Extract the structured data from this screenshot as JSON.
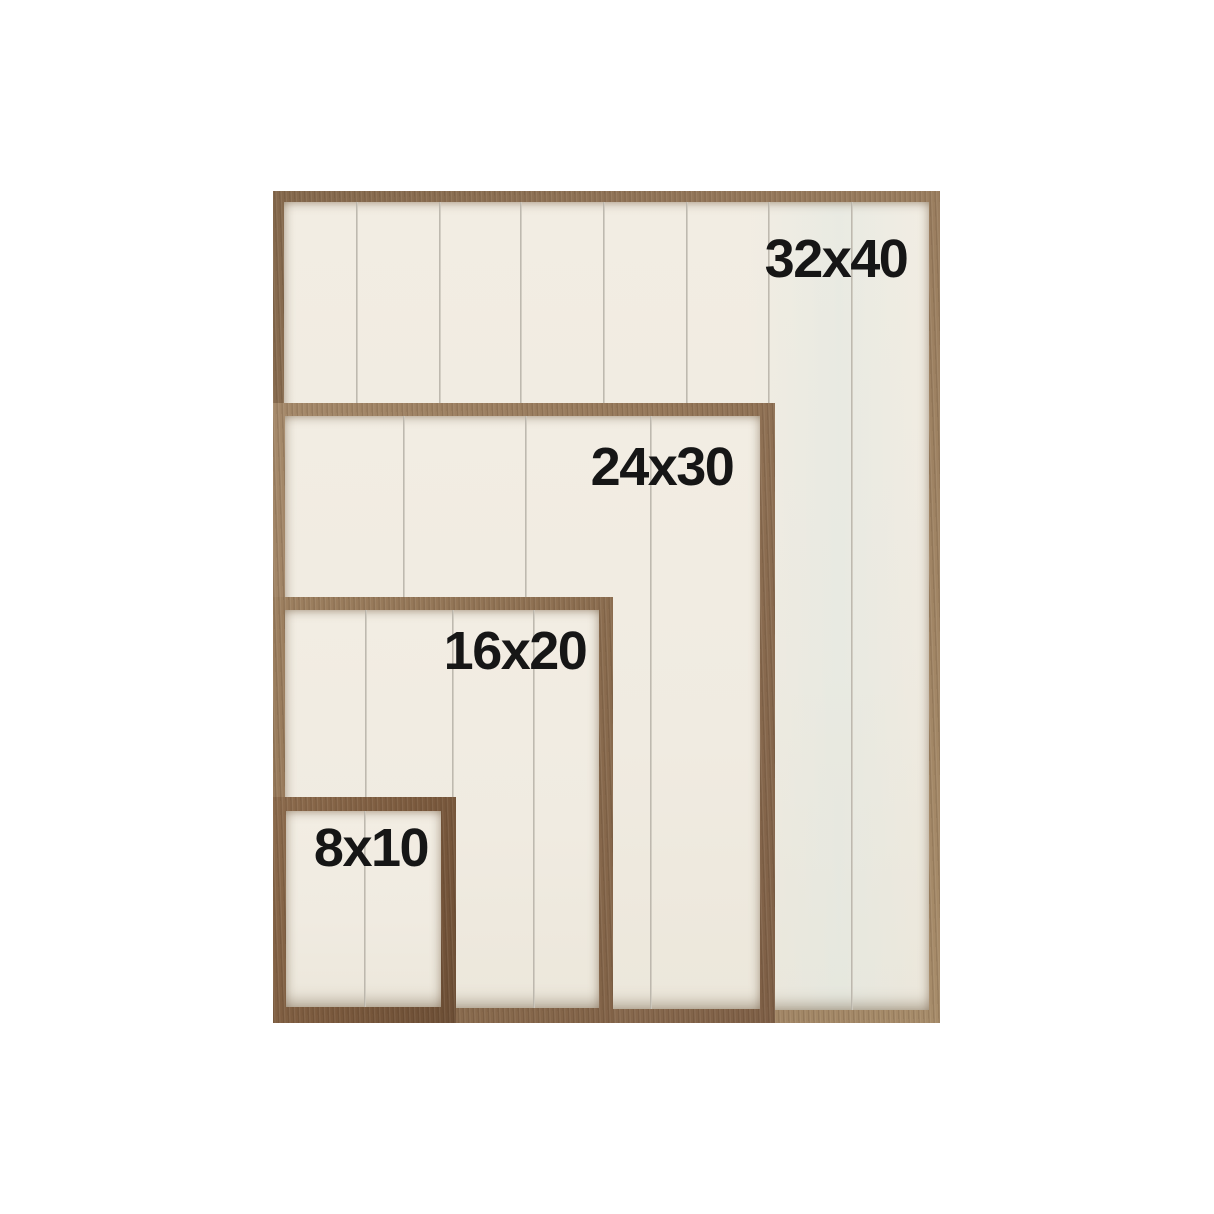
{
  "page": {
    "description": "Size comparison chart of rustic wood-framed shiplap signs nested by their shared bottom-left corner",
    "background_color": "#ffffff"
  },
  "colors": {
    "panel_cream": "#f0ebe1",
    "plank_line_gray": "#b5b0a6",
    "wood_light_tan": "#a78c6a",
    "wood_medium_brown": "#8d6f51",
    "wood_dark_walnut": "#6c4e35",
    "label_text": "#161616"
  },
  "frames": [
    {
      "id": "32x40",
      "label": "32x40",
      "width_in": 32,
      "height_in": 40,
      "planks": 8
    },
    {
      "id": "24x30",
      "label": "24x30",
      "width_in": 24,
      "height_in": 30,
      "planks": 4
    },
    {
      "id": "16x20",
      "label": "16x20",
      "width_in": 16,
      "height_in": 20,
      "planks": 4
    },
    {
      "id": "8x10",
      "label": "8x10",
      "width_in": 8,
      "height_in": 10,
      "planks": 2
    }
  ]
}
